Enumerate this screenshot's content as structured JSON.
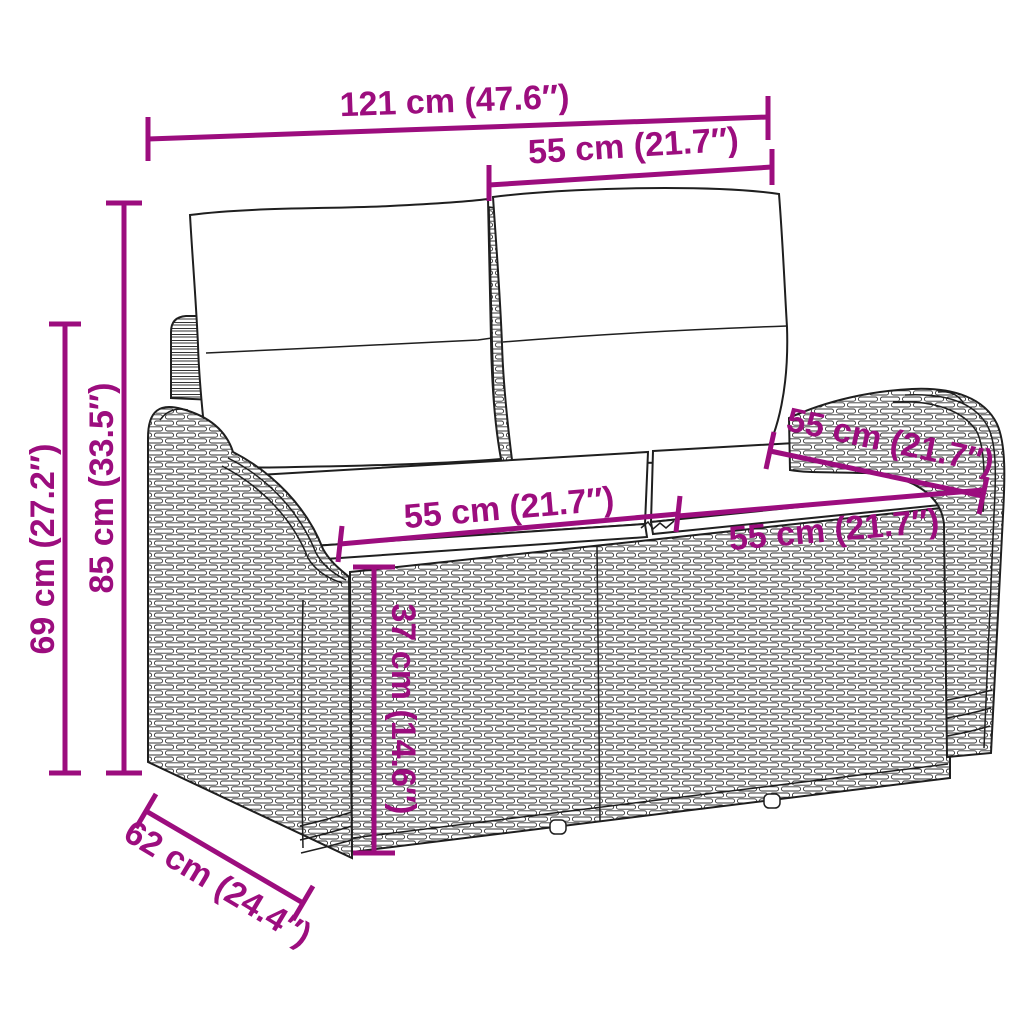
{
  "diagram": {
    "subject": "wicker-garden-bench-line-drawing",
    "style": {
      "dimension_color": "#9C0D7E",
      "line_color": "#1f1f1f",
      "background": "#ffffff"
    },
    "labels": {
      "overall_width": "121 cm (47.6″)",
      "back_section_width": "55 cm (21.7″)",
      "total_height": "85 cm (33.5″)",
      "armrest_height": "69 cm (27.2″)",
      "seat_depth": "55 cm (21.7″)",
      "left_seat_width": "55 cm (21.7″)",
      "right_seat_width": "55 cm (21.7″)",
      "seat_height": "37 cm (14.6″)",
      "overall_depth": "62 cm (24.4″)"
    }
  }
}
